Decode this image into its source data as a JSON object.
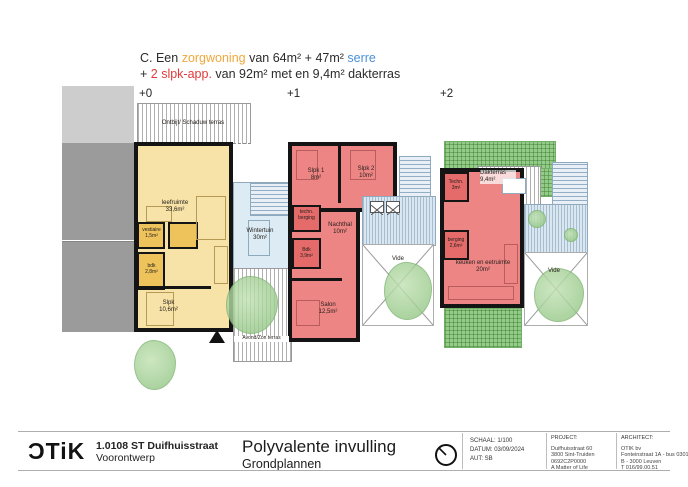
{
  "header": {
    "line1": {
      "t1": "C. Een ",
      "t2": "zorgwoning",
      "t3": " van 64m² + 47m² ",
      "t4": "serre"
    },
    "line2": {
      "t1": "+ ",
      "t2": "2 slpk-app.",
      "t3": " van 92m² met en 9,4m² dakterras"
    }
  },
  "colors": {
    "zorgwoning": "#f0a83c",
    "serre": "#4a90d9",
    "slpk_app": "#e23b3b",
    "plan_yellow": "#f7e2a8",
    "plan_red": "#ee8585",
    "plan_blue": "#dae7f1",
    "roof_green": "#93cc88"
  },
  "plans": {
    "p0": {
      "level": "+0",
      "terrace_top": "Ontbijt/ Schaduw terras",
      "rooms": {
        "leefruimte": {
          "l1": "leefruimte",
          "l2": "33,6m²"
        },
        "vestiaire": {
          "l1": "vestiaire",
          "l2": "1,5m²"
        },
        "bdk": {
          "l1": "bdk",
          "l2": "2,8m²"
        },
        "slpk": {
          "l1": "Slpk",
          "l2": "10,6m²"
        },
        "wintertuin": {
          "l1": "Wintertuin",
          "l2": "30m²"
        },
        "avond_terras": {
          "l1": "Avond/Zon terras"
        }
      }
    },
    "p1": {
      "level": "+1",
      "rooms": {
        "slpk1": {
          "l1": "Slpk 1",
          "l2": "8m²"
        },
        "slpk2": {
          "l1": "Slpk 2",
          "l2": "10m²"
        },
        "techn_berging": {
          "l1": "techn.",
          "l2": "berging"
        },
        "nachthal": {
          "l1": "Nachthal",
          "l2": "10m²"
        },
        "bdk": {
          "l1": "Bdk",
          "l2": "3,9m²"
        },
        "salon": {
          "l1": "Salon",
          "l2": "12,5m²"
        },
        "vide": {
          "l1": "Vide"
        }
      }
    },
    "p2": {
      "level": "+2",
      "rooms": {
        "dakterras": {
          "l1": "Dakterras",
          "l2": "9,4m²"
        },
        "techn": {
          "l1": "Techn.",
          "l2": "3m²"
        },
        "berging": {
          "l1": "berging",
          "l2": "2,6m²"
        },
        "keuken": {
          "l1": "keuken en eetruimte",
          "l2": "20m²"
        },
        "vide": {
          "l1": "Vide"
        }
      }
    }
  },
  "titleblock": {
    "logo": "ƆTiK",
    "project_code": "1.0108 ST Duifhuisstraat",
    "phase": "Voorontwerp",
    "title": "Polyvalente invulling",
    "subtitle": "Grondplannen",
    "schaal": "SCHAAL: 1/100",
    "datum": "DATUM: 03/09/2024",
    "aut": "AUT: SB",
    "project_header": "PROJECT:",
    "project_lines": [
      "Duifhuisstraat 60",
      "3800 Sint-Truiden",
      "0692C2P0000",
      "A Matter of Life"
    ],
    "architect_header": "ARCHITECT:",
    "architect_lines": [
      "OTIK bv",
      "Fonteinstraat 1A - bus 0301",
      "B - 3000 Leuven",
      "T 016/99.00.51"
    ]
  }
}
